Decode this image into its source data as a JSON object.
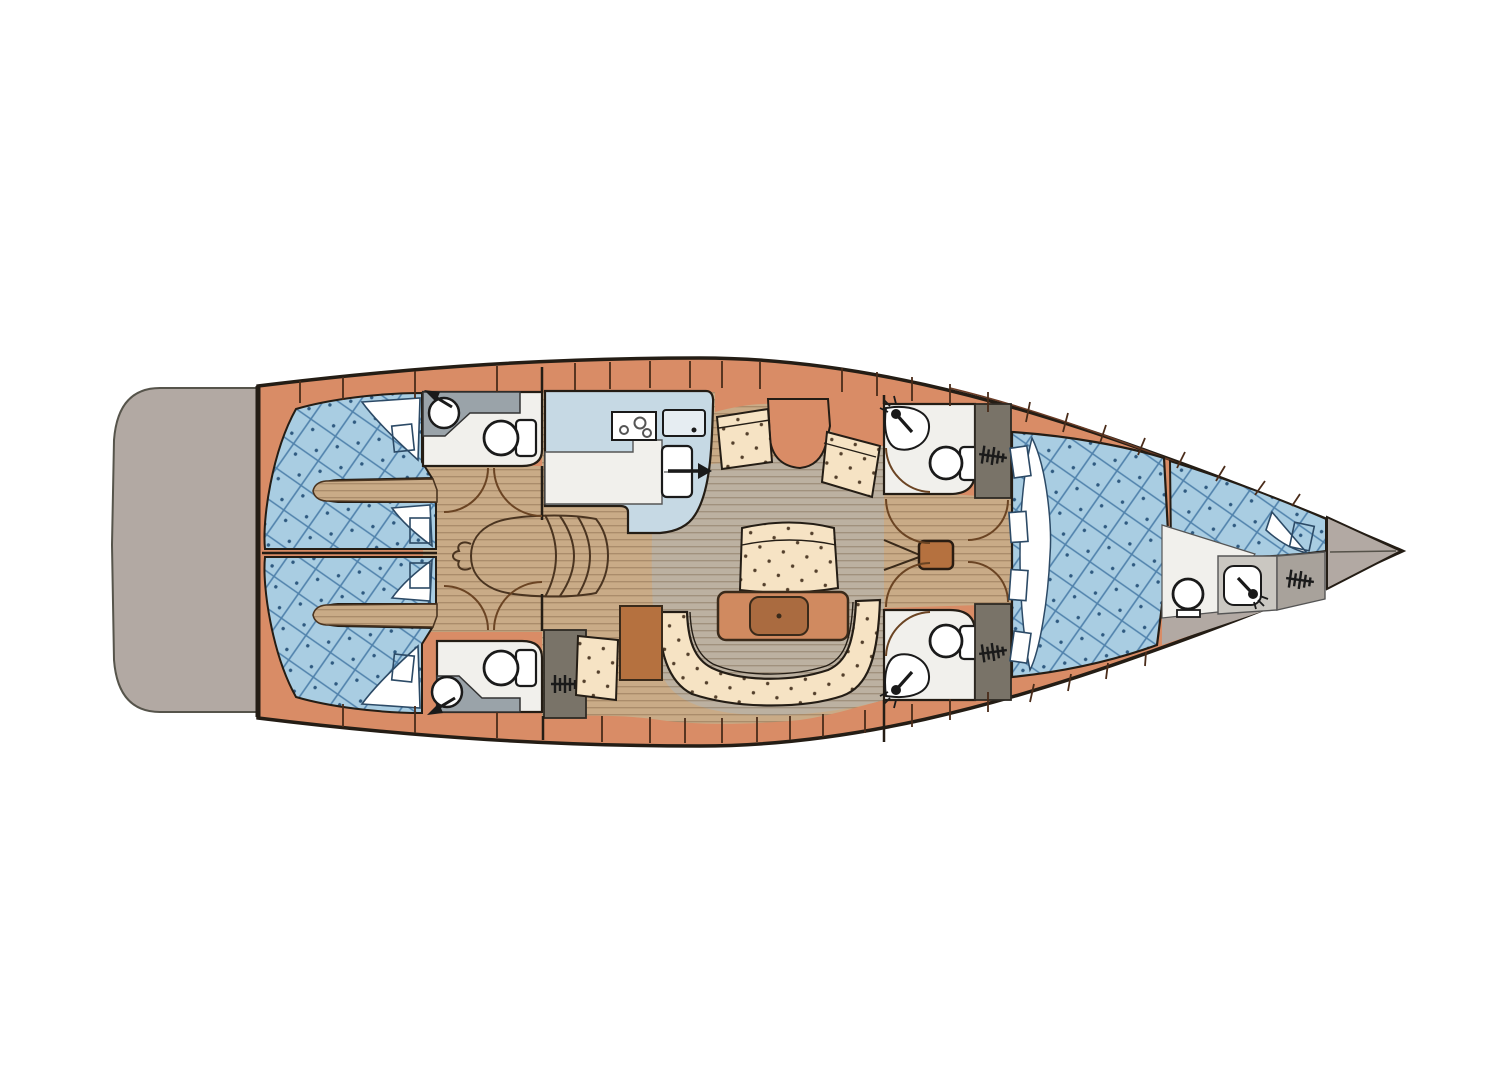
{
  "meta": {
    "description": "Sailing yacht interior layout plan, top view, bow pointing right",
    "canvas": {
      "width": 1492,
      "height": 1080
    },
    "page_bg": "#ffffff"
  },
  "palette": {
    "page-bg": "#ffffff",
    "hull-deck": "#d98c66",
    "hull-outline": "#241d15",
    "platform": "#b2a9a3",
    "platform-outline": "#56544b",
    "quilt-base": "#a9cde2",
    "quilt-grid": "#4f81ab",
    "quilt-dot": "#2f5a80",
    "wood-base": "#c9ab87",
    "wood-stripe": "#aa8c6b",
    "wood-gray-base": "#bcb1a1",
    "wood-gray-stripe": "#a0917d",
    "cream-base": "#f6e3c4",
    "cream-dot": "#54402c",
    "white-fixture": "#f1f0ec",
    "counter-gray": "#9aa3a9",
    "locker-gray": "#797368",
    "galley-blue": "#c6d9e4",
    "table-top": "#d08a60",
    "table-center": "#aa6b40",
    "seam-line": "#4a2c1a",
    "arc-brown": "#6b4423",
    "mast-brown": "#b5713f",
    "bow-taupe": "#b2a9a3",
    "ink": "#1a1a1a",
    "steps-line": "#4a3420"
  },
  "rooms": [
    "swim-platform",
    "aft-cabin-port",
    "aft-cabin-starboard",
    "aft-head-port",
    "aft-head-starboard",
    "galley",
    "salon",
    "mid-head-port",
    "mid-head-starboard",
    "owners-cabin",
    "bow-cabin",
    "bow-stowage"
  ],
  "icons": [
    "faucet-icon",
    "sink-icon",
    "toilet-icon",
    "shower-head-icon",
    "hanging-locker-icon",
    "stove-burners-icon",
    "fridge-handle-icon",
    "mast-post",
    "companionway-steps-icon",
    "salon-table",
    "door-swing-arc"
  ]
}
